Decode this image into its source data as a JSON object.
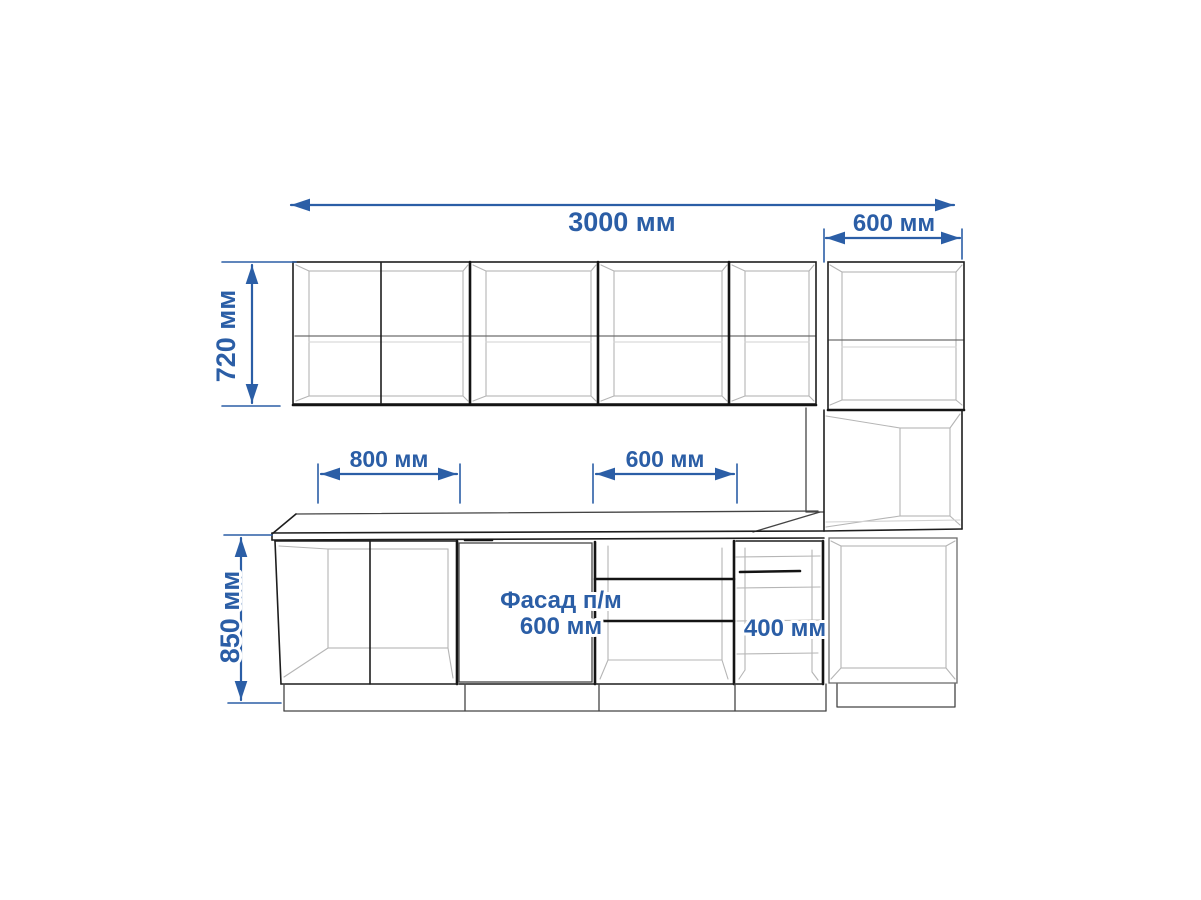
{
  "drawing": {
    "dim_total_width": "3000 мм",
    "dim_tall_width": "600 мм",
    "dim_wall_height": "720 мм",
    "dim_base_800": "800 мм",
    "dim_base_600": "600 мм",
    "dim_base_height": "850 мм",
    "dim_drawer_400": "400 мм",
    "facade_label_line1": "Фасад п/м",
    "facade_label_line2": "600 мм",
    "colors": {
      "dimension": "#2b5ea6",
      "outline": "#1e1e1e",
      "interior_line": "#b5b5b5"
    }
  }
}
